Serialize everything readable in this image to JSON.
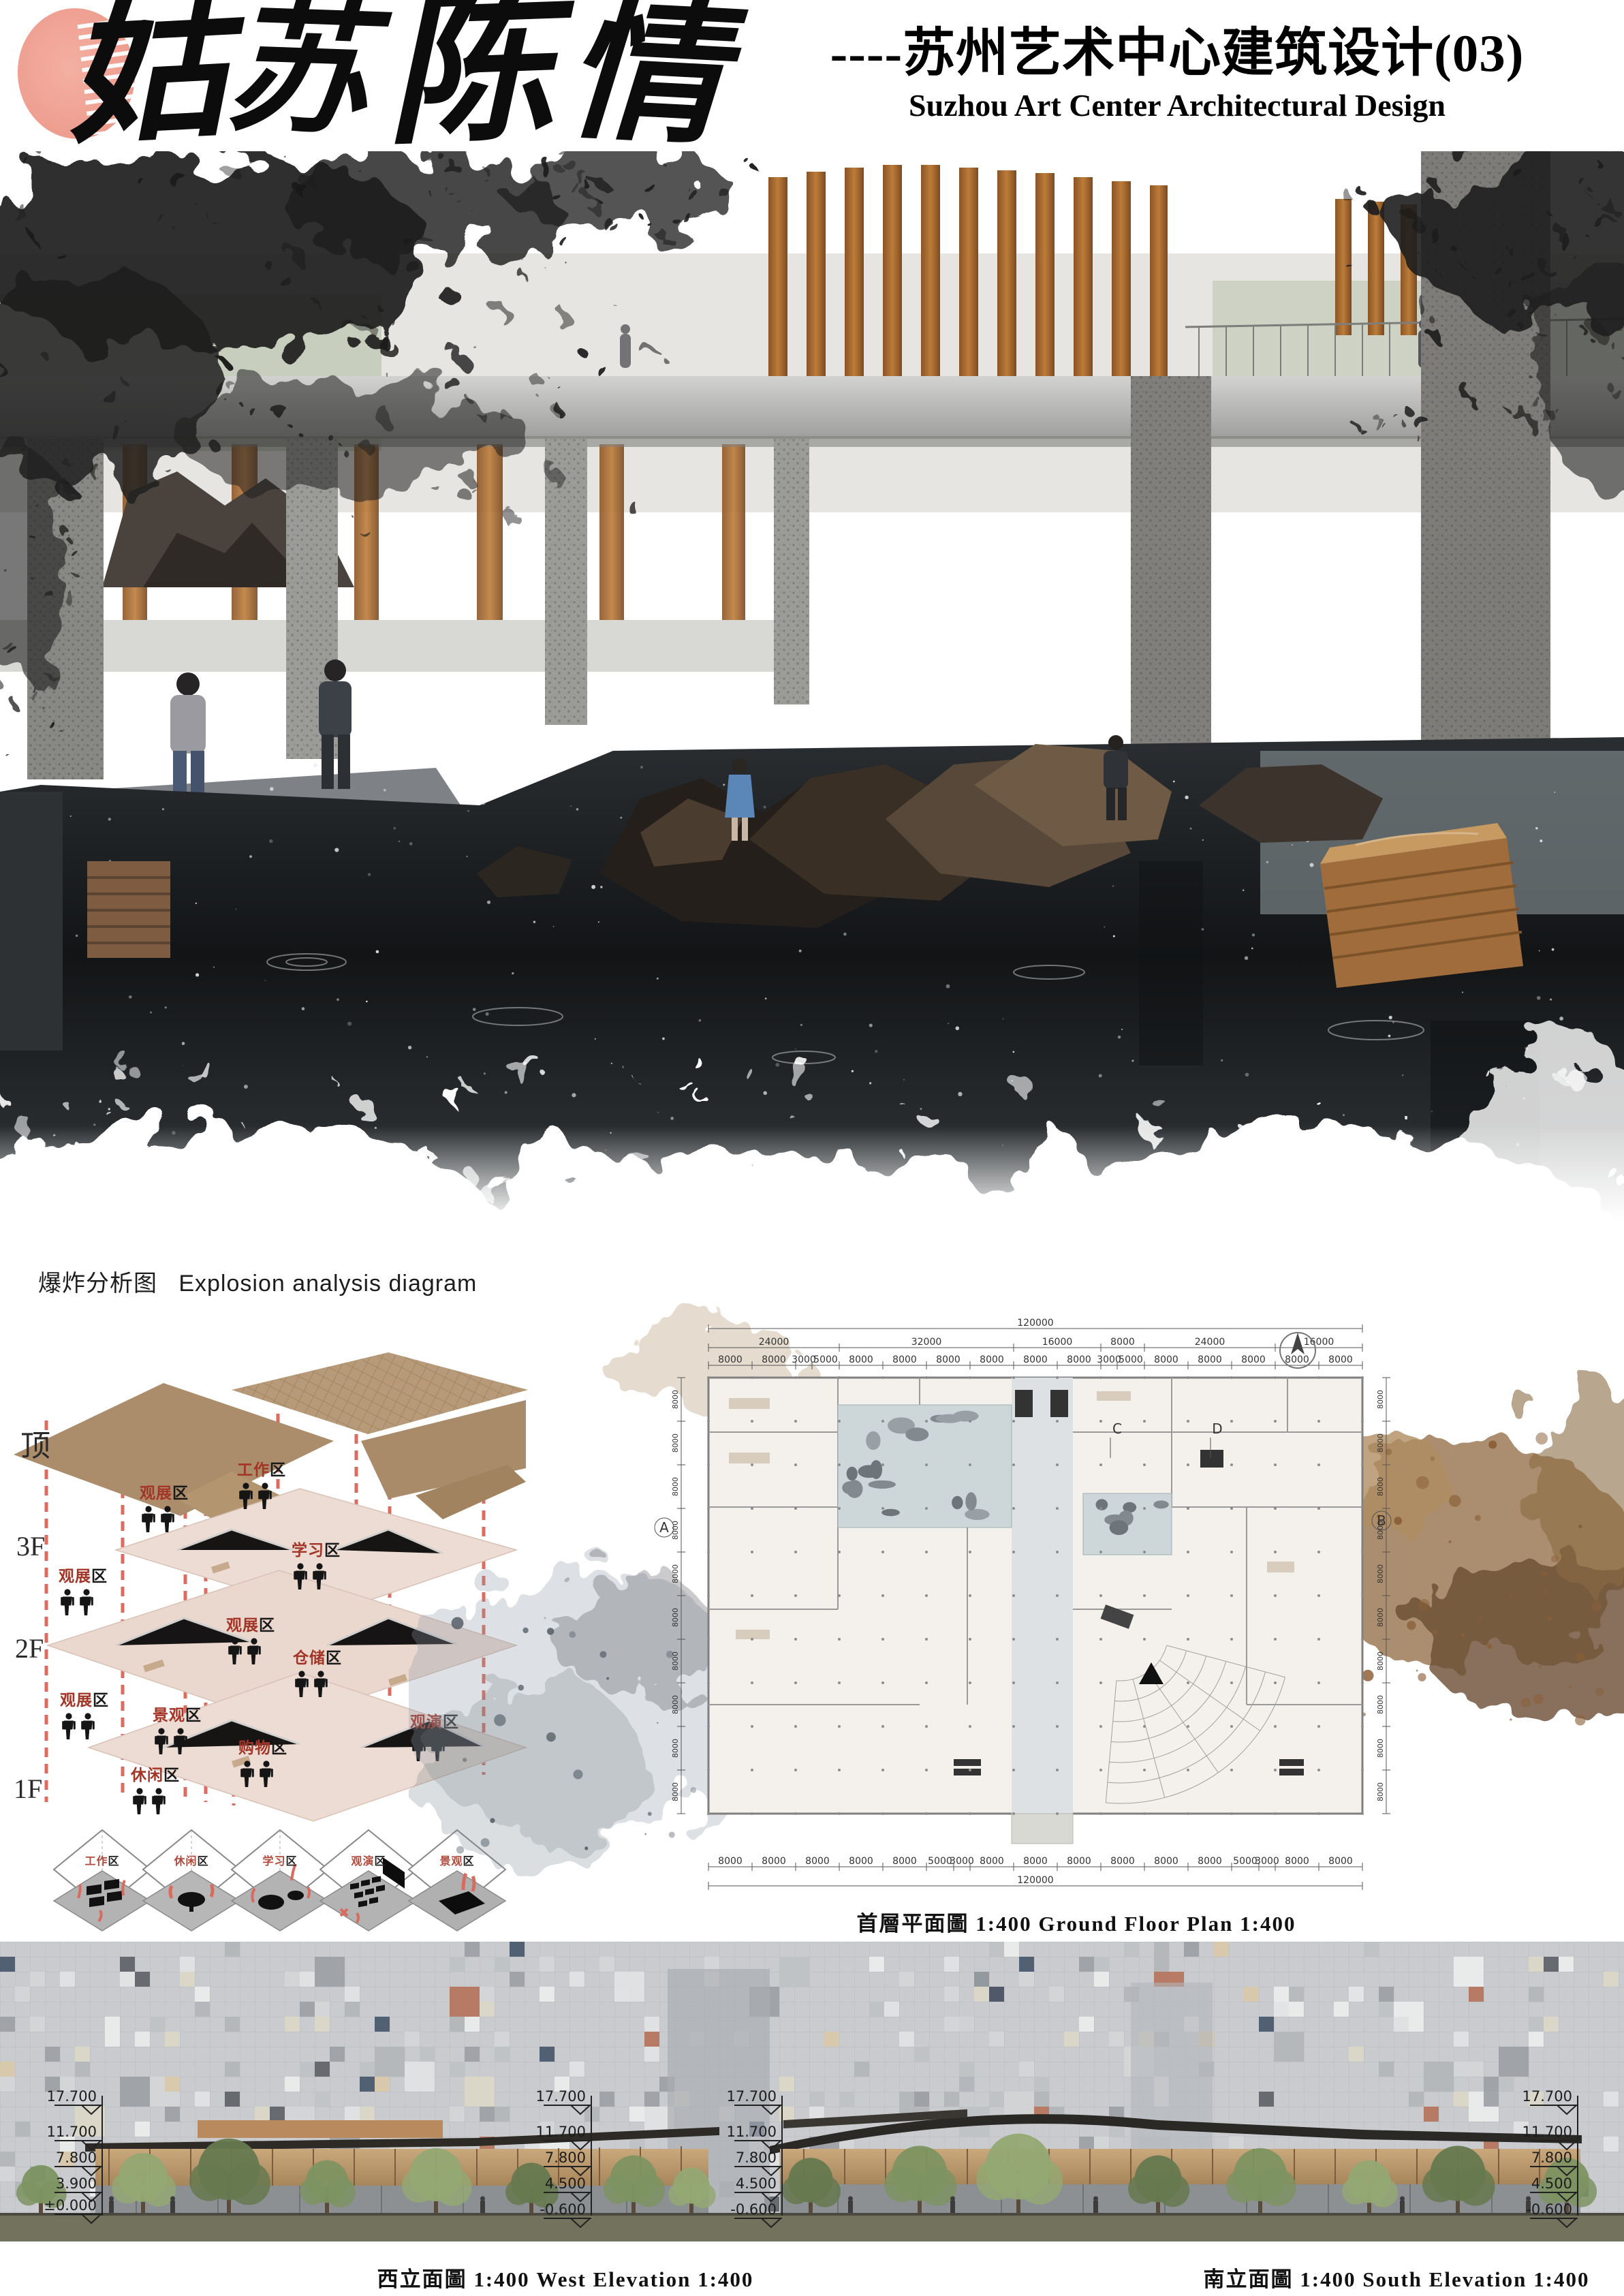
{
  "header": {
    "calligraphy": [
      "姑",
      "苏",
      "陈",
      "情"
    ],
    "subtitle_cn": "----苏州艺术中心建筑设计(03)",
    "subtitle_en": "Suzhou Art Center Architectural Design"
  },
  "explosion": {
    "title_cn": "爆炸分析图",
    "title_en": "Explosion analysis diagram",
    "floors": [
      "顶",
      "3F",
      "2F",
      "1F"
    ],
    "zones": [
      {
        "red": "观展",
        "suffix": "区"
      },
      {
        "red": "工作",
        "suffix": "区"
      },
      {
        "red": "学习",
        "suffix": "区"
      },
      {
        "red": "观展",
        "suffix": "区"
      },
      {
        "red": "观展",
        "suffix": "区"
      },
      {
        "red": "仓储",
        "suffix": "区"
      },
      {
        "red": "观展",
        "suffix": "区"
      },
      {
        "red": "景观",
        "suffix": "区"
      },
      {
        "red": "观演",
        "suffix": "区"
      },
      {
        "red": "购物",
        "suffix": "区"
      },
      {
        "red": "休闲",
        "suffix": "区"
      }
    ],
    "cubes": [
      {
        "red": "工作",
        "suffix": "区"
      },
      {
        "red": "休闲",
        "suffix": "区"
      },
      {
        "red": "学习",
        "suffix": "区"
      },
      {
        "red": "观演",
        "suffix": "区"
      },
      {
        "red": "景观",
        "suffix": "区"
      }
    ]
  },
  "plan": {
    "caption": "首層平面圖  1:400  Ground  Floor  Plan  1:400",
    "grid_letters": {
      "a": "A",
      "b": "B",
      "c": "C",
      "d": "D"
    },
    "dims": {
      "total": "120000",
      "row2": [
        "24000",
        "32000",
        "16000",
        "8000",
        "24000",
        "16000"
      ],
      "row3": [
        "8000",
        "8000",
        "3000",
        "5000",
        "8000",
        "8000",
        "8000",
        "8000",
        "8000",
        "8000",
        "3000",
        "5000",
        "8000",
        "8000",
        "8000",
        "8000",
        "8000"
      ],
      "side": "8000",
      "total_bottom": "120000"
    }
  },
  "elevations": {
    "west_caption": "西立面圖  1:400  West  Elevation  1:400",
    "south_caption": "南立面圖  1:400  South  Elevation  1:400",
    "marker_columns": [
      {
        "levels": [
          "17.700",
          "11.700",
          "7.800",
          "3.900",
          "±0.000"
        ]
      },
      {
        "levels": [
          "17.700",
          "11.700",
          "7.800",
          "4.500",
          "-0.600"
        ]
      },
      {
        "levels": [
          "17.700",
          "11.700",
          "7.800",
          "4.500",
          "-0.600"
        ]
      },
      {
        "levels": [
          "17.700",
          "11.700",
          "7.800",
          "4.500",
          "-0.600"
        ]
      }
    ]
  },
  "colors": {
    "seal": "#efa193",
    "zone_red": "#a33527",
    "dash_red": "#dd6b5f",
    "roof_tan": "#ab8d6c",
    "plate_rose": "#eddcd4",
    "wood": "#b06f33",
    "ground_olive": "#73725c"
  }
}
